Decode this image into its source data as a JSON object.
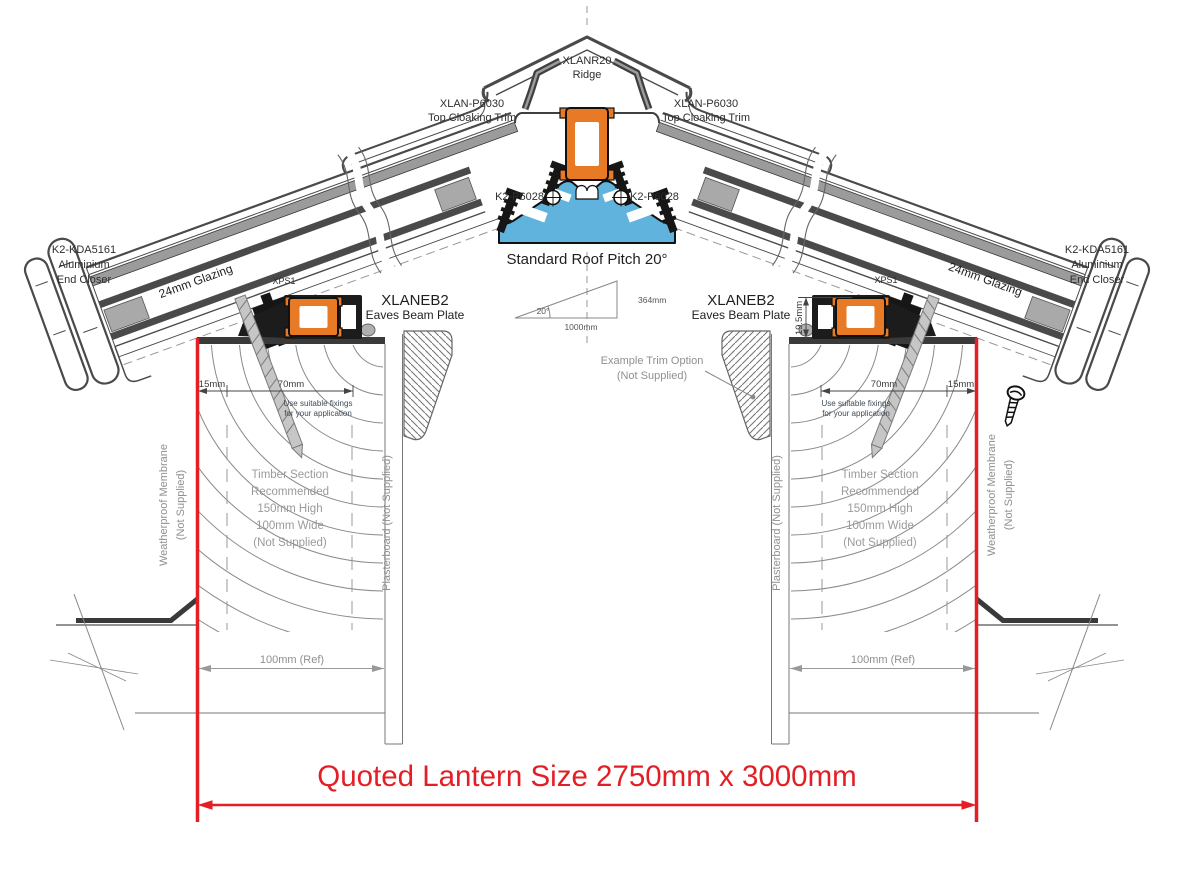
{
  "drawing_title": "Roof lantern eaves and ridge cross section detail",
  "colors": {
    "dimension_red": "#e41e25",
    "profile_orange": "#e87a25",
    "ridge_beam_blue": "#5fb3dc",
    "outline_dark": "#1c1c1c",
    "frame_gray": "#9b9b9b",
    "note_gray": "#9a9a9a",
    "text_dark": "#2e2e2e"
  },
  "labels": {
    "ridge": {
      "l1": "XLANR20",
      "l2": "Ridge"
    },
    "top_cloaking_left": {
      "l1": "XLAN-P6030",
      "l2": "Top Cloaking Trim"
    },
    "top_cloaking_right": {
      "l1": "XLAN-P6030",
      "l2": "Top Cloaking Trim"
    },
    "k2_p6028_left": "K2-P6028",
    "k2_p6028_right": "K2-P6028",
    "pitch_title": "Standard Roof Pitch 20°",
    "pitch_triangle": {
      "angle": "20°",
      "base": "1000mm",
      "rise": "364mm"
    },
    "end_closer_left": {
      "l1": "K2-KDA5161",
      "l2": "Aluminium",
      "l3": "End Closer"
    },
    "end_closer_right": {
      "l1": "K2-KDA5161",
      "l2": "Aluminium",
      "l3": "End Closer"
    },
    "glazing_left": "24mm Glazing",
    "glazing_right": "24mm Glazing",
    "xps1_left": "XPS1",
    "xps1_right": "XPS1",
    "eaves_left": {
      "l1": "XLANEB2",
      "l2": "Eaves Beam Plate"
    },
    "eaves_right": {
      "l1": "XLANEB2",
      "l2": "Eaves Beam Plate"
    },
    "beam_upstand": "19.5mm",
    "trim_option": {
      "l1": "Example Trim Option",
      "l2": "(Not Supplied)"
    },
    "dims": {
      "left_15": "15mm",
      "left_70": "70mm",
      "right_70": "70mm",
      "right_15": "15mm"
    },
    "fixings_left": {
      "l1": "Use suitable fixings",
      "l2": "for your application"
    },
    "fixings_right": {
      "l1": "Use suitable fixings",
      "l2": "for your application"
    },
    "timber_left": {
      "l1": "Timber Section",
      "l2": "Recommended",
      "l3": "150mm High",
      "l4": "100mm Wide",
      "l5": "(Not Supplied)"
    },
    "timber_right": {
      "l1": "Timber Section",
      "l2": "Recommended",
      "l3": "150mm High",
      "l4": "100mm Wide",
      "l5": "(Not Supplied)"
    },
    "membrane_left": {
      "l1": "Weatherproof Membrane",
      "l2": "(Not Supplied)"
    },
    "membrane_right": {
      "l1": "Weatherproof Membrane",
      "l2": "(Not Supplied)"
    },
    "plasterboard_left": "Plasterboard (Not Supplied)",
    "plasterboard_right": "Plasterboard (Not Supplied)",
    "ref_left": "100mm (Ref)",
    "ref_right": "100mm (Ref)",
    "quoted_size": "Quoted Lantern Size 2750mm x 3000mm"
  }
}
